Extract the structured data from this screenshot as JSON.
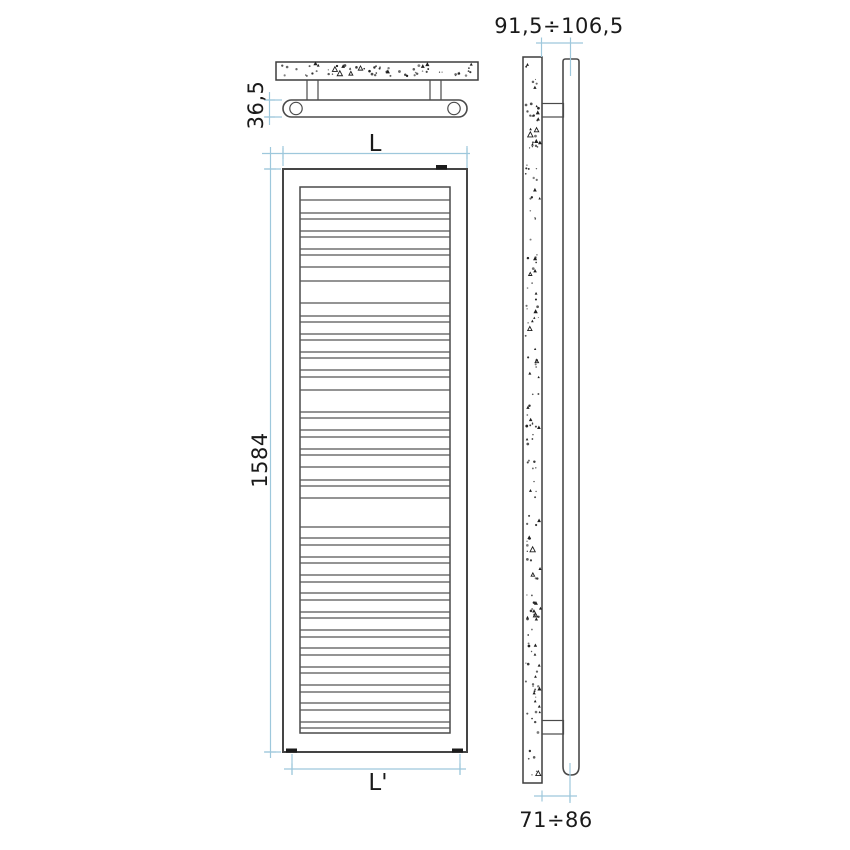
{
  "drawing": {
    "type": "radiator-technical-drawing",
    "views": {
      "top_view": {
        "name": "top-view",
        "depth_dimension": "36,5"
      },
      "front_view": {
        "name": "front-view",
        "width_dimension": "L",
        "height_dimension": "1584",
        "bottom_width_dimension": "L'",
        "slat_lines": [
          200,
          213,
          219,
          231,
          237,
          249,
          255,
          267,
          281,
          303,
          316,
          322,
          334,
          340,
          352,
          358,
          370,
          377,
          390,
          412,
          418,
          430,
          437,
          449,
          455,
          467,
          480,
          486,
          498,
          527,
          538,
          545,
          557,
          563,
          575,
          582,
          593,
          600,
          612,
          618,
          630,
          637,
          648,
          655,
          667,
          673,
          685,
          692,
          703,
          710,
          722,
          728
        ]
      },
      "side_view": {
        "name": "side-view",
        "wall_distance_top": "91,5÷106,5",
        "wall_distance_bottom": "71÷86"
      }
    },
    "colors": {
      "dimension_line": "#9ec8dc",
      "drawing_line": "#4a4a4a",
      "text": "#1a1a1a",
      "background": "#ffffff"
    }
  }
}
